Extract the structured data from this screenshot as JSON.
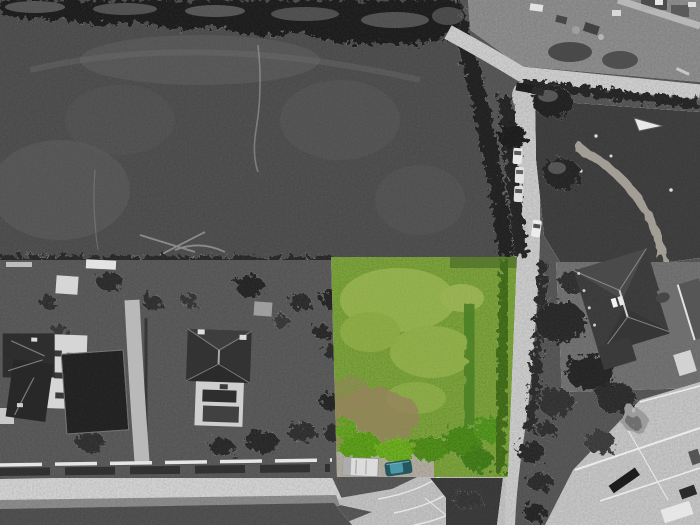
{
  "scene": {
    "kind": "aerial-drone-photograph",
    "description": "Grayscale aerial photo of fields, roads and houses with one land parcel highlighted in colour green",
    "palette": {
      "plot_green": "#7da43c",
      "plot_green_light": "#aabf60",
      "plot_hedge_green": "#47731f",
      "plot_bush_green": "#64a521",
      "plot_brown_patch": "#97805f",
      "field_gray": "#525252",
      "tree_gray": "#232323",
      "road_light": "#d2d2d2",
      "road_dark": "#535353",
      "sidewalk_gray": "#d6d6d6",
      "yard_gray": "#909090",
      "roof_dark": "#404040",
      "neighbor_roof_gray": "#6f6f6f",
      "facade_white": "#d6d6d6",
      "garden_bed_dark": "#262626",
      "concrete_light": "#c9c9c9",
      "gravel_warm": "#b6b0a4",
      "vehicle_white": "#e6e6e6",
      "vehicle_dark": "#222222"
    },
    "vehicles": {
      "teal_car_body": "#24565f",
      "teal_car_glass": "#4d98a6",
      "parked_cars_count": "4"
    }
  }
}
